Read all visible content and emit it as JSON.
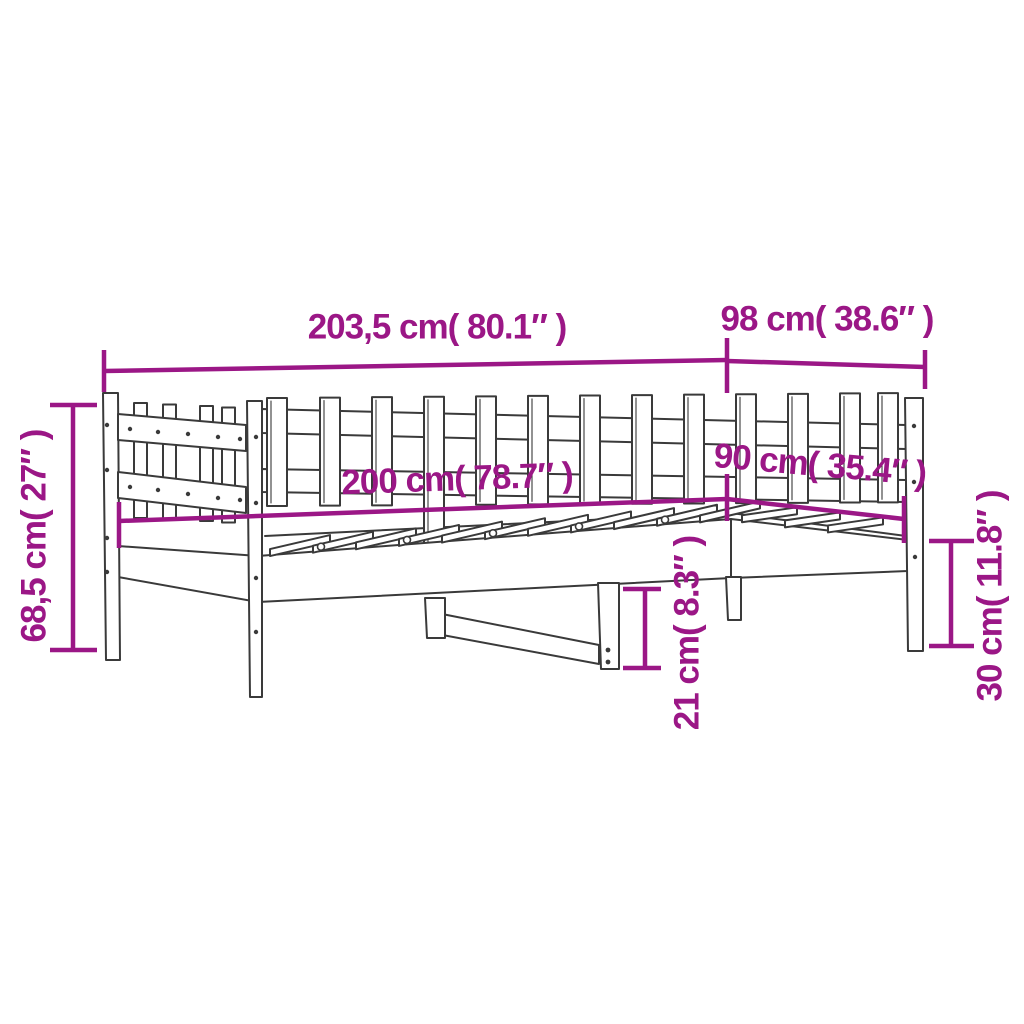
{
  "diagram": {
    "type": "product-dimension-diagram",
    "product": "wooden daybed with slatted backrest and side panel",
    "background_color": "#FFFFFF",
    "accent_color": "#9B1786",
    "line_color": "#3A3A3A",
    "dimensions": {
      "outer_length": {
        "label": "203,5 cm( 80.1″ )",
        "cm": "203,5",
        "inches": "80.1"
      },
      "outer_depth": {
        "label": "98 cm( 38.6″ )",
        "cm": "98",
        "inches": "38.6"
      },
      "total_height": {
        "label": "68,5 cm( 27″ )",
        "cm": "68,5",
        "inches": "27"
      },
      "inner_length": {
        "label": "200 cm( 78.7″ )",
        "cm": "200",
        "inches": "78.7"
      },
      "inner_width": {
        "label": "90 cm( 35.4″ )",
        "cm": "90",
        "inches": "35.4"
      },
      "under_bed_clearance": {
        "label": "21 cm( 8.3″ )",
        "cm": "21",
        "inches": "8.3"
      },
      "frame_side_height": {
        "label": "30 cm( 11.8″ )",
        "cm": "30",
        "inches": "11.8"
      }
    }
  }
}
